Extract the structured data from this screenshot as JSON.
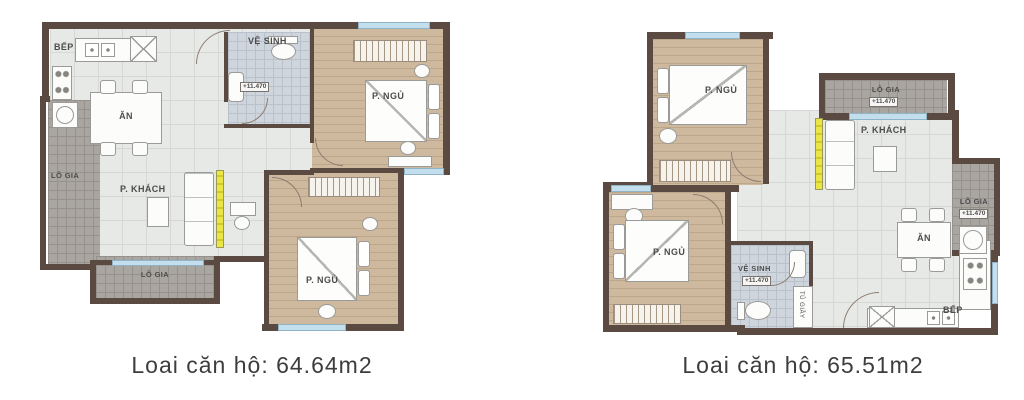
{
  "captions": {
    "plan1": "Loai căn hộ: 64.64m2",
    "plan2": "Loai căn hộ: 65.51m2"
  },
  "plan1": {
    "kitchen": "BẾP",
    "dining": "ĂN",
    "bathroom": "VỆ SINH",
    "bathroom_level": "+11.470",
    "living": "P. KHÁCH",
    "bedroom1": "P. NGỦ",
    "bedroom2": "P. NGỦ",
    "loggia_left": "LÔ GIA",
    "loggia_bottom": "LÔ GIA"
  },
  "plan2": {
    "bedroom1": "P. NGỦ",
    "bedroom2": "P. NGỦ",
    "living": "P. KHÁCH",
    "dining": "ĂN",
    "kitchen": "BẾP",
    "bathroom": "VỆ SINH",
    "bathroom_level": "+11.470",
    "loggia_top": "LÔ GIA",
    "loggia_top_level": "+11.470",
    "loggia_right": "LÔ GIA",
    "loggia_right_level": "+11.470",
    "shoe_cabinet": "TỦ GIẦY"
  },
  "colors": {
    "wall": "#5b4a42",
    "tile_floor": "#e7e9e7",
    "wood_floor": "#ceb89e",
    "bath_floor": "#cfd5dc",
    "loggia_floor": "#a9a5a0",
    "window": "#c3dfee",
    "accent_yellow": "#e9e646",
    "text": "#3d3d3d"
  }
}
